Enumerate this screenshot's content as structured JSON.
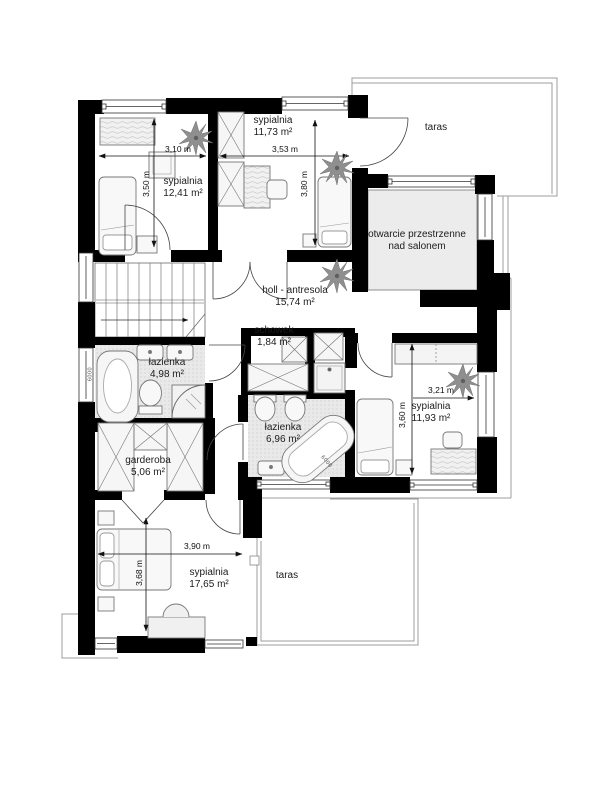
{
  "rooms": {
    "sypialnia_tl": {
      "name": "sypialnia",
      "area": "12,41 m²"
    },
    "sypialnia_tm": {
      "name": "sypialnia",
      "area": "11,73 m²"
    },
    "sypialnia_right": {
      "name": "sypialnia",
      "area": "11,93 m²"
    },
    "sypialnia_bottom": {
      "name": "sypialnia",
      "area": "17,65 m²"
    },
    "holl": {
      "name": "holl - antresola",
      "area": "15,74 m²"
    },
    "schowek": {
      "name": "schowek",
      "area": "1,84 m²"
    },
    "lazienka_gorna": {
      "name": "łazienka",
      "area": "4,98 m²"
    },
    "lazienka_dolna": {
      "name": "łazienka",
      "area": "6,96 m²"
    },
    "garderoba": {
      "name": "garderoba",
      "area": "5,06 m²"
    },
    "taras_gorny": {
      "name": "taras"
    },
    "taras_dolny": {
      "name": "taras"
    },
    "otwarcie": {
      "line1": "otwarcie przestrzenne",
      "line2": "nad salonem"
    }
  },
  "dimensions": {
    "tl_width": "3,10 m",
    "tl_height": "3,50 m",
    "tm_width": "3,53 m",
    "tm_height": "3,80 m",
    "right_width": "3,21 m",
    "right_height": "3,60 m",
    "bottom_width": "3,90 m",
    "bottom_height": "3,68 m"
  },
  "annotations": {
    "tub_code_1": "6000",
    "tub_code_2": "6000"
  },
  "colors": {
    "wall": "#000000",
    "bath_floor": "#e9e9e9",
    "open_space": "#ececec",
    "plant": "#8f8f8f",
    "dimension": "#111111"
  }
}
